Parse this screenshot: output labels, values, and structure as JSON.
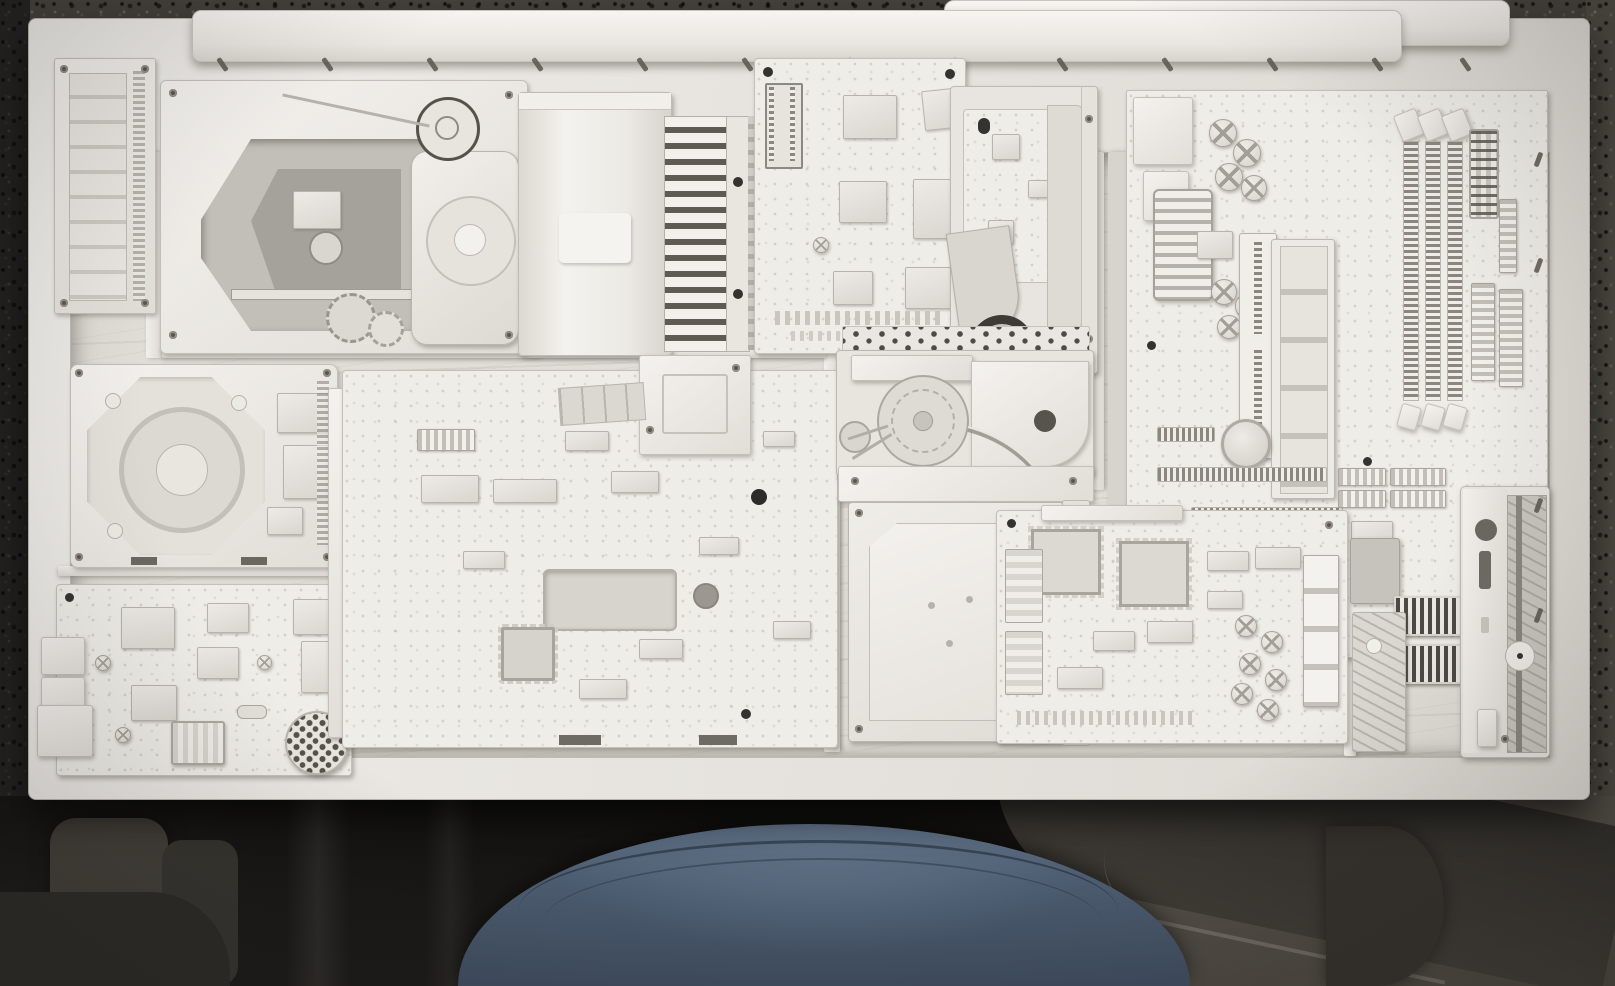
{
  "scene": {
    "description": "Overhead photograph of an art assemblage: salvaged computer components painted entirely white and arranged like a mosaic inside a shallow white wooden tray frame. The frame rests over the photographer's lap; below it are a dark shadowed chair, the photographer's knee in blue jeans, and a dark speckled terrazzo floor.",
    "medium": "photograph",
    "visible_text": "none"
  },
  "artwork": {
    "frame": {
      "label": "white wooden tray frame with raised rim",
      "color": "#e9e6e1"
    },
    "backing": {
      "label": "white-painted wood backing with visible grain and slat dividers",
      "color": "#e1ded8"
    },
    "ledge_upper": {
      "label": "raised white wooden ledge across the top"
    },
    "ledge_lower": {
      "label": "second raised white ledge at the upper right"
    },
    "vent_marks": {
      "label": "small dark angled slots along the inner frame wall"
    }
  },
  "components": {
    "simm_module": {
      "label": "white-painted SIMM memory module standing vertically at the left edge"
    },
    "cdrom_mechanism": {
      "label": "white-painted CD-ROM drive mechanism with laser sled opening, spindle platform, gears and belt pulley"
    },
    "drive_cover": {
      "label": "white-painted drive top cover panel"
    },
    "heatsink": {
      "label": "white-painted finned heatsink"
    },
    "controller_board": {
      "label": "white-painted controller PCB with DIP socket and square ICs"
    },
    "slim_optical_drive": {
      "label": "white-painted slim optical drive with folded ribbon cable and dark spindle motor ring"
    },
    "motherboard_top_right": {
      "label": "white-painted motherboard section with capacitors, connectors and expansion slots"
    },
    "parallel_port": {
      "label": "white-painted parallel-port connector"
    },
    "dimm_slots": {
      "label": "three white-painted DIMM sockets with latch clips"
    },
    "vertical_ram": {
      "label": "white-painted RAM stick with blank chip pads"
    },
    "atx_connector": {
      "label": "white-painted ATX power connector"
    },
    "ribbon_headers": {
      "label": "white-painted IDC ribbon-cable headers"
    },
    "cmos_battery": {
      "label": "white-painted coin-cell CMOS battery in holder"
    },
    "pci_slot_rows": {
      "label": "white-painted PCI slot rows"
    },
    "hard_drive_pcb": {
      "label": "white-painted hard drive shown PCB-side up with spindle motor ring"
    },
    "modem_card": {
      "label": "white-painted modem card with RJ11 jacks, transformer and piezo speaker"
    },
    "piezo_speaker": {
      "label": "round piezo speaker with hole grid"
    },
    "main_pcb": {
      "label": "large white-painted logic board with rectangular cutout, holes and QFP chips"
    },
    "daughter_board": {
      "label": "small white-painted daughter board"
    },
    "ribbon_cable": {
      "label": "folded white ribbon cable"
    },
    "belt_mechanism": {
      "label": "white-painted belt-drive loading mechanism with large pulley and small motor"
    },
    "thin_wire": {
      "label": "thin pale wire looping over the mechanism"
    },
    "hard_drive_top": {
      "label": "white-painted hard drive shown top-side up with chamfered lid"
    },
    "audio_board": {
      "label": "white-painted audio board with QFP chips, capacitor cluster and relay blocks"
    },
    "pin_headers": {
      "label": "dark dual-row pin header strips"
    },
    "floppy_bezel": {
      "label": "white-painted floppy drive front bezel with eject button, slot and spindle disc"
    },
    "spindle_disc": {
      "label": "small white spindle disc"
    }
  },
  "surroundings": {
    "floor_top": {
      "label": "dark speckled terrazzo floor behind the frame",
      "color": "#44413b"
    },
    "shadow_zone": {
      "label": "deep shadow beneath the table",
      "color": "#131211"
    },
    "jeans_knee": {
      "label": "photographer's knee in blue jeans with seam lines",
      "color": "#4e5d70"
    },
    "chair_left": {
      "label": "dark chair legs in shadow",
      "color": "#3c3a35"
    },
    "chair_edge_right": {
      "label": "dark rounded chair edge",
      "color": "#393631"
    },
    "floor_bottom_right": {
      "label": "gray-brown floor at lower right",
      "color": "#514c45"
    }
  },
  "palette": {
    "part_white": "#f2f0ec",
    "part_shadow": "#c7c4be",
    "dark_accent": "#55514b",
    "granite": "#44413b",
    "denim": "#4e5d70",
    "wood_backing": "#e1ded8"
  }
}
